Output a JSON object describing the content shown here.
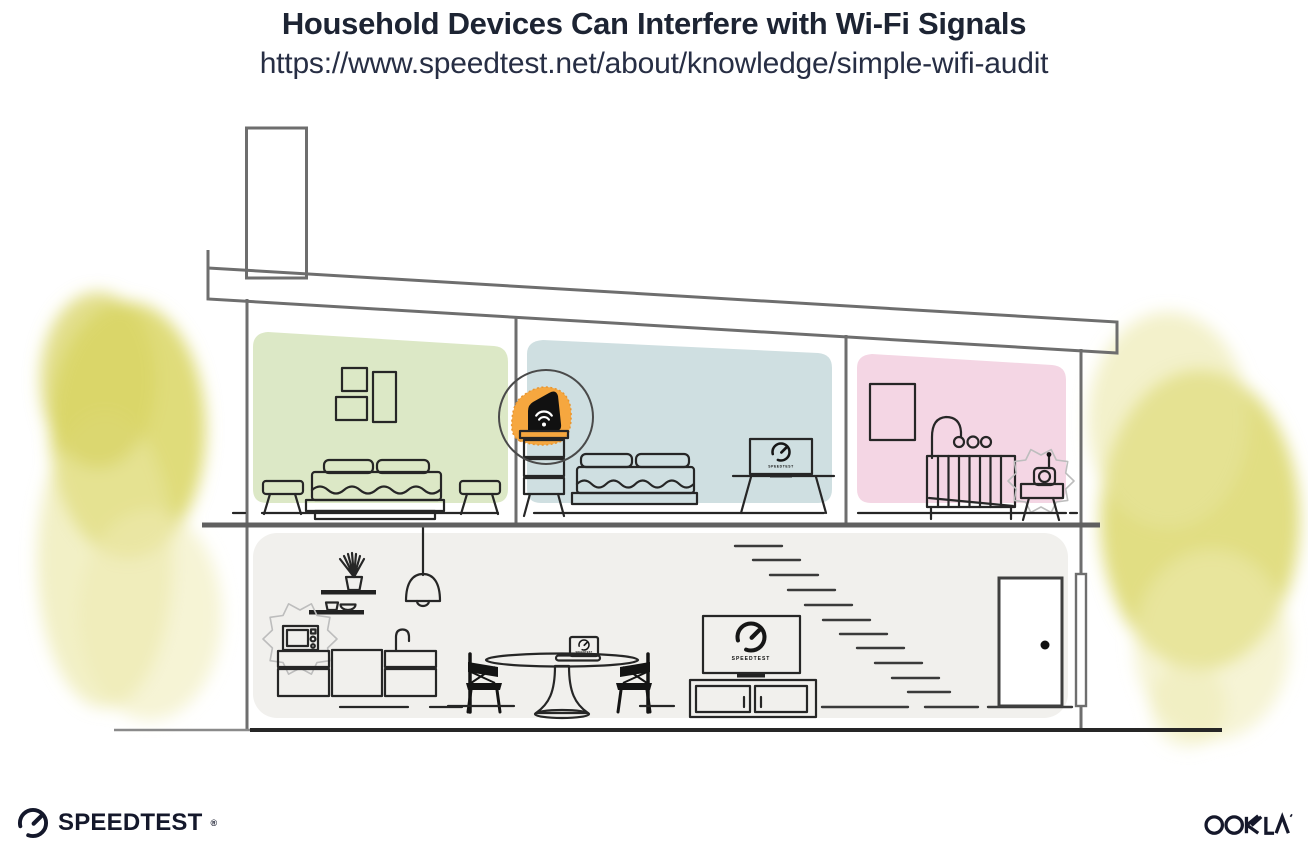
{
  "header": {
    "title": "Household Devices Can Interfere with Wi-Fi Signals",
    "url": "https://www.speedtest.net/about/knowledge/simple-wifi-audit"
  },
  "screens": {
    "tv_label": "SPEEDTEST",
    "desk_monitor_label": "SPEEDTEST",
    "laptop_label": "SPEEDTEST"
  },
  "footer": {
    "speedtest_logo_text": "SPEEDTEST",
    "speedtest_reg_mark": "®",
    "ookla_logo_text": "OOKLA",
    "ookla_reg_mark": "®"
  },
  "colors": {
    "title_text": "#1d2433",
    "url_text": "#272e44",
    "room_green": "#dce8c6",
    "room_blue": "#cfdfe1",
    "room_pink": "#f4d6e4",
    "ground_floor": "#f1f0ed",
    "router_orange": "#f6a73f",
    "foliage_yellow": "#dcd86c",
    "foliage_light": "#e9e6a0",
    "wall_gray": "#6e6e6e",
    "ink": "#262626"
  }
}
